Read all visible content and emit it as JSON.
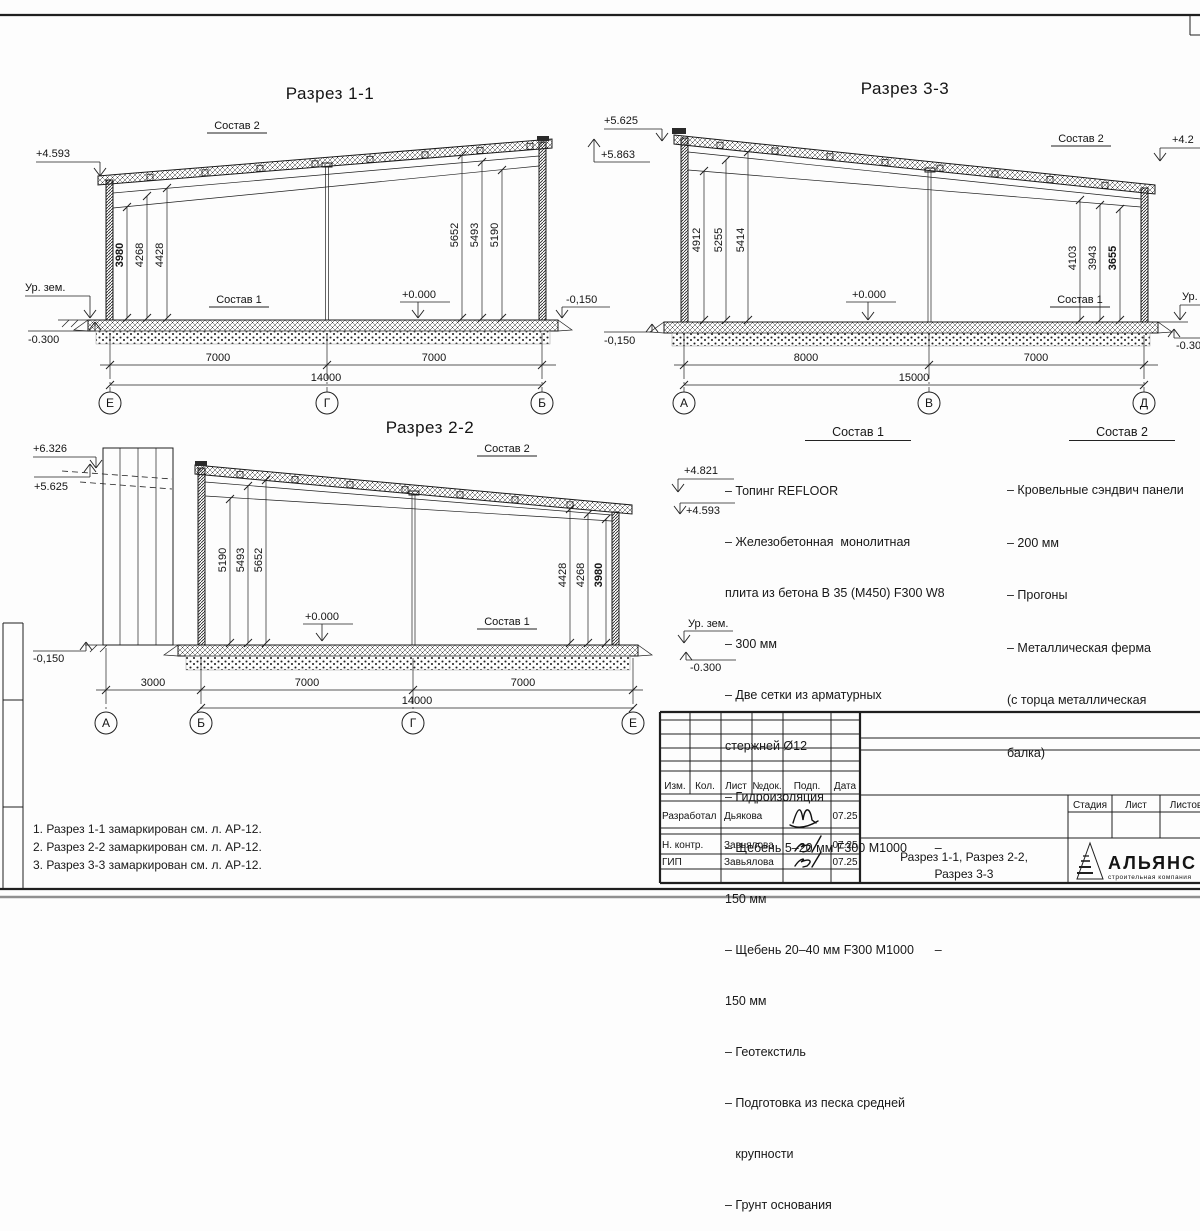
{
  "labels": {
    "sostav1": "Состав 1",
    "sostav2": "Состав 2",
    "zero": "+0.000",
    "ur_zem": "Ур. зем."
  },
  "sections": {
    "s11": {
      "title": "Разрез 1-1",
      "elev": {
        "top_left": "+4.593",
        "ground": "-0.300",
        "right": "-0,150"
      },
      "dims_left": [
        "3980",
        "4268",
        "4428"
      ],
      "dims_right": [
        "5652",
        "5493",
        "5190"
      ],
      "spans": [
        "7000",
        "7000"
      ],
      "total": "14000",
      "axes": [
        "Е",
        "Г",
        "Б"
      ]
    },
    "s33": {
      "title": "Разрез 3-3",
      "elev": {
        "top1": "+5.625",
        "top2": "+5.863",
        "left_bottom": "-0,150",
        "right_top": "+4.2",
        "right_ur": "Ур. зем.",
        "right_bottom": "-0.300"
      },
      "dims_left": [
        "4912",
        "5255",
        "5414"
      ],
      "dims_right": [
        "4103",
        "3943",
        "3655"
      ],
      "spans": [
        "8000",
        "7000"
      ],
      "total": "15000",
      "axes": [
        "А",
        "В",
        "Д"
      ]
    },
    "s22": {
      "title": "Разрез 2-2",
      "elev": {
        "top1": "+6.326",
        "top2": "+5.625",
        "right1": "+4.821",
        "right2": "+4.593",
        "left_bottom": "-0,150",
        "ur": "Ур. зем.",
        "ground": "-0.300"
      },
      "dims_left": [
        "5190",
        "5493",
        "5652"
      ],
      "dims_right": [
        "4428",
        "4268",
        "3980"
      ],
      "spans": [
        "3000",
        "7000",
        "7000"
      ],
      "total": "14000",
      "axes": [
        "А",
        "Б",
        "Г",
        "Е"
      ]
    }
  },
  "compositions": {
    "c1": {
      "title": "Состав 1",
      "lines": [
        "– Топинг REFLOOR",
        "– Железобетонная  монолитная",
        "плита из бетона В 35 (М450) F300 W8",
        "– 300 мм",
        "– Две сетки из арматурных",
        "стержней Ø12",
        "– Гидроизоляция",
        "– Щебень 5–20 мм F300 М1000        –",
        "150 мм",
        "– Щебень 20–40 мм F300 М1000      –",
        "150 мм",
        "– Геотекстиль",
        "– Подготовка из песка средней",
        "   крупности",
        "– Грунт основания"
      ]
    },
    "c2": {
      "title": "Состав 2",
      "lines": [
        "– Кровельные сэндвич панели",
        "– 200 мм",
        "– Прогоны",
        "– Металлическая ферма",
        "(с торца металлическая",
        "балка)"
      ]
    }
  },
  "notes": [
    "1. Разрез 1-1 замаркирован см. л. АР-12.",
    "2. Разрез 2-2 замаркирован см. л. АР-12.",
    "3. Разрез 3-3 замаркирован см. л. АР-12."
  ],
  "titleblock": {
    "columns": [
      "Изм.",
      "Кол.",
      "Лист",
      "№док.",
      "Подп.",
      "Дата"
    ],
    "rows": [
      {
        "role": "Разработал",
        "name": "Дьякова",
        "date": "07.25"
      },
      {
        "role": "Н. контр.",
        "name": "Завьялова",
        "date": "07.25"
      },
      {
        "role": "ГИП",
        "name": "Завьялова",
        "date": "07.25"
      }
    ],
    "stage_cols": [
      "Стадия",
      "Лист",
      "Листов"
    ],
    "title_line1": "Разрез 1-1, Разрез 2-2,",
    "title_line2": "Разрез 3-3",
    "logo": {
      "name": "АЛЬЯНС",
      "tagline": "строительная компания"
    }
  },
  "colors": {
    "marker": "#4a1010",
    "logo_blue": "#16368c",
    "logo_light": "#3f63c8"
  }
}
